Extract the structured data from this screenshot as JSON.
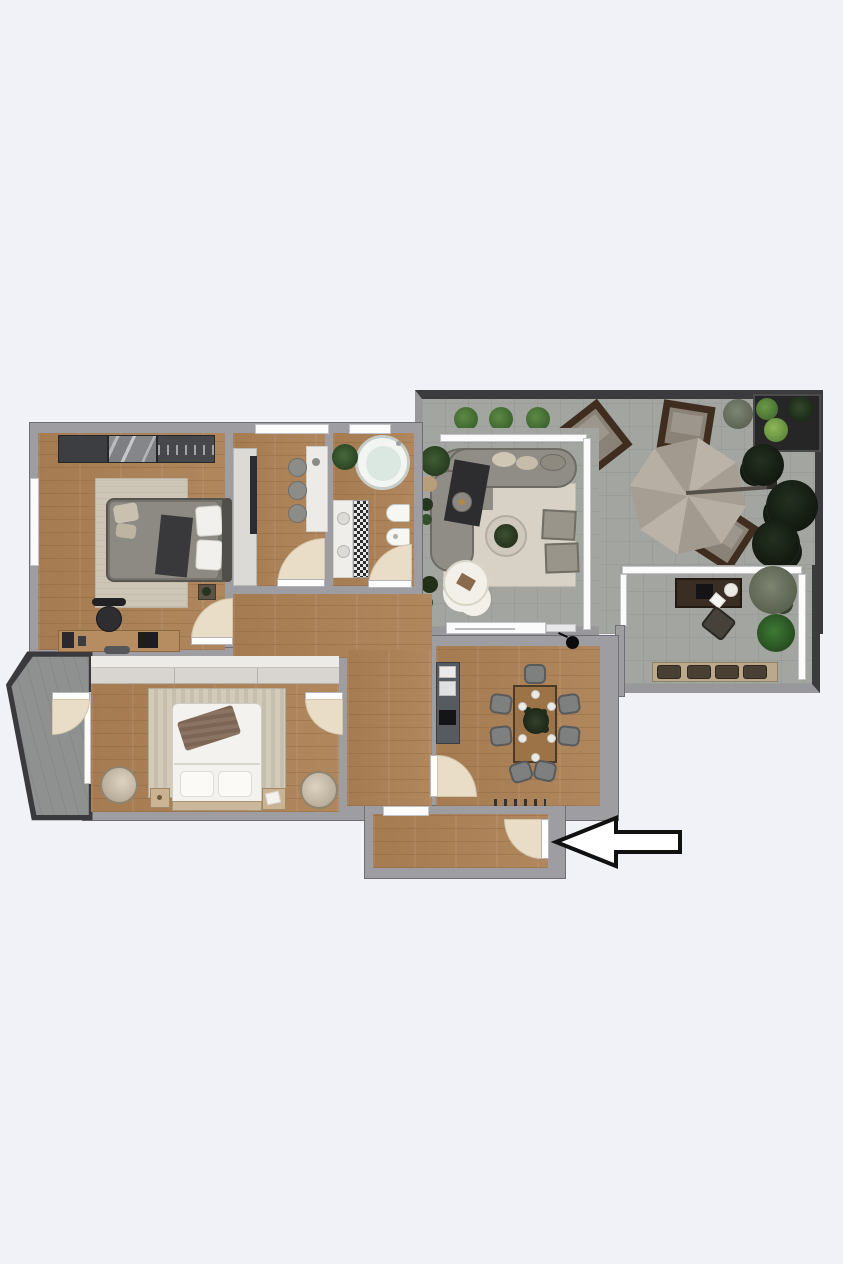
{
  "meta": {
    "title": "apartment-floor-plan-render",
    "description": "Top-down 3D rendered floor plan of an apartment with large terrace; a black outlined arrow marks the entrance door on the lower right",
    "canvas": {
      "width": 843,
      "height": 1264
    },
    "visible_text": []
  },
  "palette": {
    "bg": "#f1f2f7",
    "wall": "#9d9da2",
    "wallDark": "#3b3b3d",
    "wood": "#ac8055",
    "tile": "#a3a5a1",
    "balconyTile": "#8e9190",
    "rug": "#d8d2c6",
    "rugStripe": "#cdc6b6",
    "doorfill": "#e9ddc8",
    "sofa": "#908d86",
    "umbrella": "#b4aba0",
    "darkFurniture": "#2f2f33",
    "plantGreen": "#456b3a",
    "plantDark": "#1d2a1a",
    "plantLight": "#6fa03f",
    "arrowStroke": "#111111",
    "arrowFill": "#ffffff"
  },
  "annotation": {
    "type": "arrow",
    "direction": "left",
    "points_to": "entrance-door"
  },
  "rooms": [
    {
      "id": "terrace",
      "floor": "tile",
      "furniture": [
        "bushes",
        "planter-box",
        "lounge-chair",
        "lounge-chair",
        "lounge-chair",
        "patio-umbrella",
        "trees"
      ]
    },
    {
      "id": "terrace-office-nook",
      "floor": "tile",
      "furniture": [
        "desk",
        "desk-chair",
        "ball-lamp",
        "laptop",
        "plants",
        "bench-with-cushions"
      ]
    },
    {
      "id": "living-room",
      "floor": "tile",
      "furniture": [
        "curved-sofa",
        "rug",
        "coffee-table-with-plant",
        "armchair",
        "armchair",
        "cloud-pouf",
        "side-plants",
        "sliding-door"
      ]
    },
    {
      "id": "bedroom-top-left",
      "floor": "wood",
      "furniture": [
        "wardrobe",
        "rug",
        "double-bed",
        "nightstand",
        "desk",
        "desk-chair",
        "laptop"
      ]
    },
    {
      "id": "kitchenette",
      "floor": "wood",
      "furniture": [
        "tall-cabinet",
        "oven-column",
        "counter",
        "stool",
        "stool",
        "stool"
      ]
    },
    {
      "id": "bathroom",
      "floor": "wood",
      "furniture": [
        "round-tub",
        "plant",
        "double-vanity",
        "mosaic-strip",
        "toilet",
        "bidet"
      ]
    },
    {
      "id": "corridor",
      "floor": "wood",
      "furniture": []
    },
    {
      "id": "bedroom-bottom-left",
      "floor": "wood",
      "furniture": [
        "wardrobe",
        "striped-rug",
        "double-bed",
        "nightstand",
        "nightstand",
        "barrel-chair",
        "barrel-chair"
      ]
    },
    {
      "id": "dining-kitchen",
      "floor": "wood",
      "furniture": [
        "kitchen-counter",
        "dining-table",
        "chairs-x7",
        "pendant-lamp",
        "radiator"
      ]
    },
    {
      "id": "entrance-hall",
      "floor": "wood",
      "furniture": [
        "entrance-door"
      ]
    },
    {
      "id": "balcony",
      "floor": "balcony-tile",
      "furniture": [
        "railing"
      ]
    }
  ]
}
